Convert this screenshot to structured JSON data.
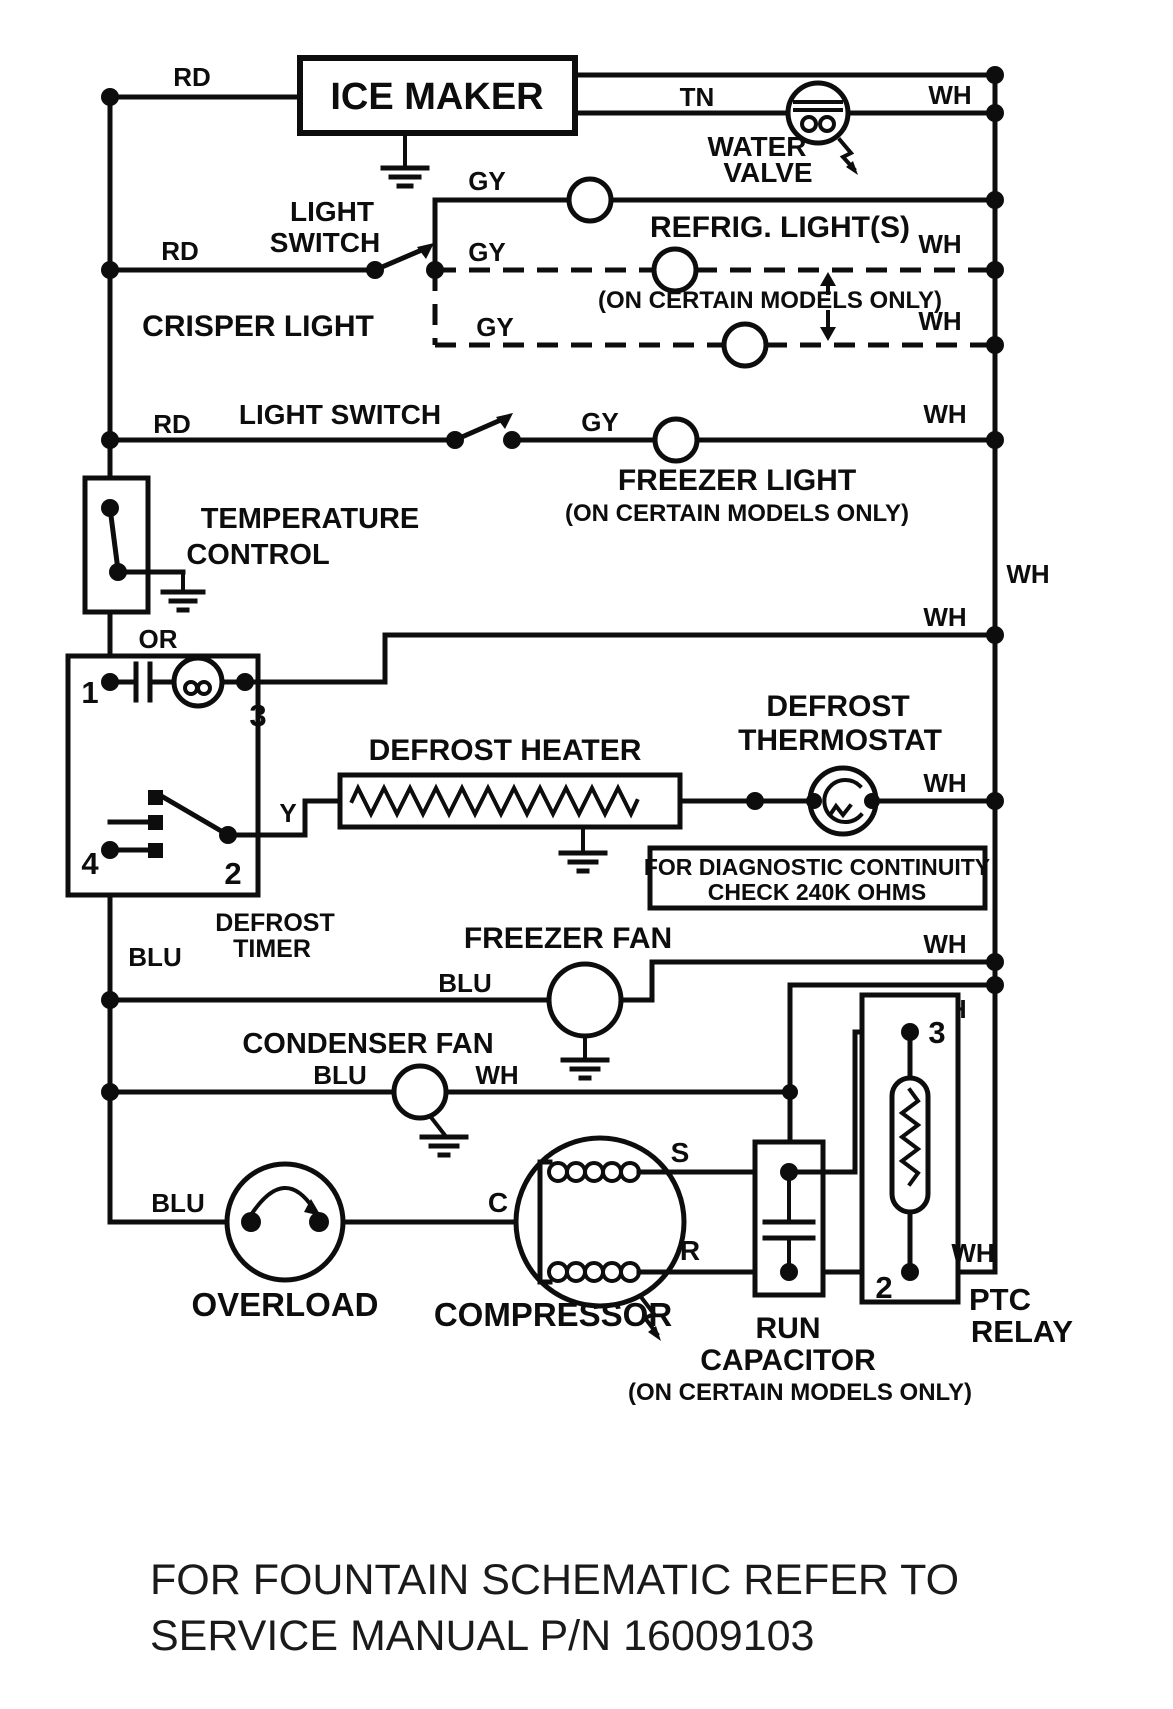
{
  "colors": {
    "background": "#ffffff",
    "ink": "#0d0d0d"
  },
  "labels": {
    "rd_ice": "RD",
    "ice_maker": "ICE MAKER",
    "tn": "TN",
    "wh_valve": "WH",
    "water": "WATER",
    "valve": "VALVE",
    "gy_refrig": "GY",
    "refrig_lights": "REFRIG. LIGHT(S)",
    "light_1": "LIGHT",
    "switch_1": "SWITCH",
    "rd_switch1": "RD",
    "gy_dash1": "GY",
    "wh_dash1": "WH",
    "note_models_1": "(ON CERTAIN MODELS ONLY)",
    "gy_dash2": "GY",
    "wh_dash2": "WH",
    "crisper_light": "CRISPER LIGHT",
    "light_switch_2": "LIGHT SWITCH",
    "rd_switch2": "RD",
    "gy_freezer": "GY",
    "wh_freezer": "WH",
    "freezer_light": "FREEZER LIGHT",
    "note_models_2": "(ON CERTAIN MODELS ONLY)",
    "wh_rail": "WH",
    "temperature": "TEMPERATURE",
    "control": "CONTROL",
    "or_wire": "OR",
    "wh_defrost_line": "WH",
    "timer_1": "1",
    "timer_3": "3",
    "timer_2": "2",
    "timer_4": "4",
    "defrost": "DEFROST",
    "timer": "TIMER",
    "y_wire": "Y",
    "blu_rail": "BLU",
    "defrost_heater": "DEFROST HEATER",
    "defrost_thermo_1": "DEFROST",
    "defrost_thermo_2": "THERMOSTAT",
    "wh_thermo": "WH",
    "diag_line1": "FOR DIAGNOSTIC CONTINUITY",
    "diag_line2": "CHECK 240K OHMS",
    "freezer_fan": "FREEZER FAN",
    "blu_freezer_fan": "BLU",
    "wh_freezer_fan": "WH",
    "wh_branch": "WH",
    "condenser_fan": "CONDENSER FAN",
    "blu_condenser": "BLU",
    "wh_condenser": "WH",
    "blu_overload": "BLU",
    "overload": "OVERLOAD",
    "compressor": "COMPRESSOR",
    "c_term": "C",
    "s_term": "S",
    "r_term": "R",
    "run": "RUN",
    "capacitor": "CAPACITOR",
    "note_models_3": "(ON CERTAIN MODELS ONLY)",
    "ptc_3": "3",
    "ptc_2": "2",
    "wh_ptc": "WH",
    "ptc": "PTC",
    "relay": "RELAY",
    "caption_line1": "FOR FOUNTAIN SCHEMATIC REFER TO",
    "caption_line2": "SERVICE MANUAL P/N 16009103"
  }
}
